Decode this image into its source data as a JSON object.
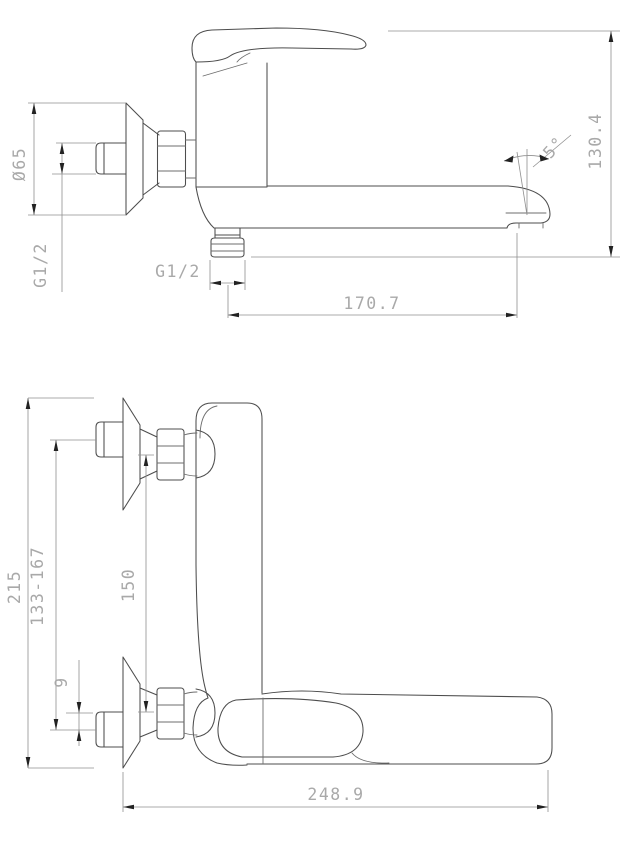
{
  "document": {
    "type": "technical drawing",
    "subject": "wall-mounted single-lever faucet, two orthographic views with dimensions"
  },
  "colors": {
    "background": "#ffffff",
    "object_line": "#4d4d4d",
    "dimension_line": "#909090",
    "dimension_text": "#a9a9a9",
    "arrowhead": "#222222"
  },
  "views": {
    "side_view": {
      "name": "side elevation",
      "dimensions": {
        "flange_diameter": "Ø65",
        "inlet_thread": "G1/2",
        "outlet_thread": "G1/2",
        "spout_reach": "170.7",
        "overall_height": "130.4",
        "spout_angle": "5°"
      }
    },
    "plan_view": {
      "name": "plan view",
      "dimensions": {
        "overall_depth": "215",
        "inlet_adjust_range": "133-167",
        "union_centers": "150",
        "eccentric_offset": "9",
        "overall_length": "248.9"
      }
    }
  }
}
